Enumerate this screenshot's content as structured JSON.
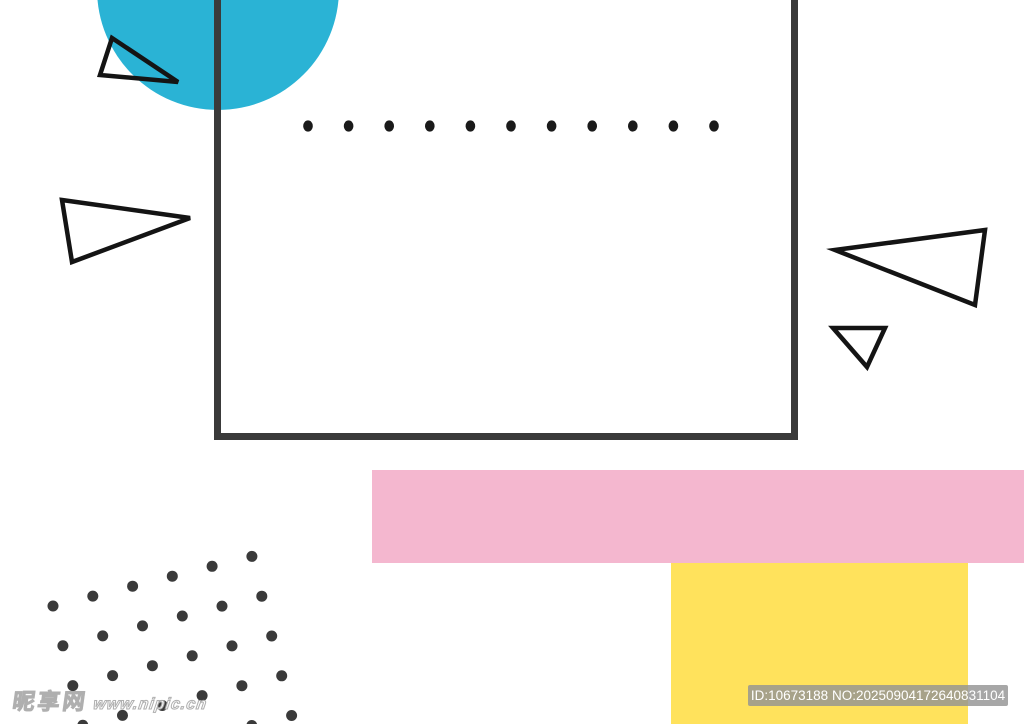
{
  "watermark": {
    "site_name": "昵享网",
    "site_url": "www.nipic.cn"
  },
  "badge": {
    "text": "ID:10673188 NO:20250904172640831104"
  },
  "colors": {
    "background": "#ffffff",
    "circle_blue": "#2ab3d5",
    "frame_gray": "#3a3a3a",
    "triangle_outline": "#141414",
    "dot_row_black": "#1a1a1a",
    "dot_grid_gray": "#3a3a3a",
    "pink": "#f4b7cf",
    "yellow": "#ffe25c",
    "badge_bg": "rgba(148,148,148,0.82)",
    "badge_text": "#ffffff"
  },
  "shapes": {
    "circle": {
      "cx": 218,
      "cy": -11,
      "r": 121
    },
    "frame": {
      "x": 214,
      "y": -24,
      "width": 584,
      "height": 464,
      "stroke_width": 7
    },
    "dot_row": {
      "x_start": 308,
      "y": 126,
      "count": 11,
      "spacing": 40.6,
      "rx": 4.8,
      "ry": 5.6
    },
    "triangles": [
      {
        "name": "triangle-outline-top-left",
        "points": "112,38 100,75 178,82"
      },
      {
        "name": "triangle-outline-mid-left",
        "points": "62,200 190,218 72,262"
      },
      {
        "name": "triangle-outline-right-large",
        "points": "985,230 835,250 975,305"
      },
      {
        "name": "triangle-outline-right-small",
        "points": "833,328 885,328 867,367"
      }
    ],
    "triangle_stroke_width": 4.5,
    "pink_rect": {
      "x": 372,
      "y": 470,
      "width": 652,
      "height": 93
    },
    "yellow_rect": {
      "x": 671,
      "y": 563,
      "width": 297,
      "height": 161
    },
    "dot_grid": {
      "origin_x": 53,
      "origin_y": 606,
      "cols": 6,
      "rows": 5,
      "spacing": 41,
      "angle_deg": -14,
      "radius": 5.5
    }
  }
}
